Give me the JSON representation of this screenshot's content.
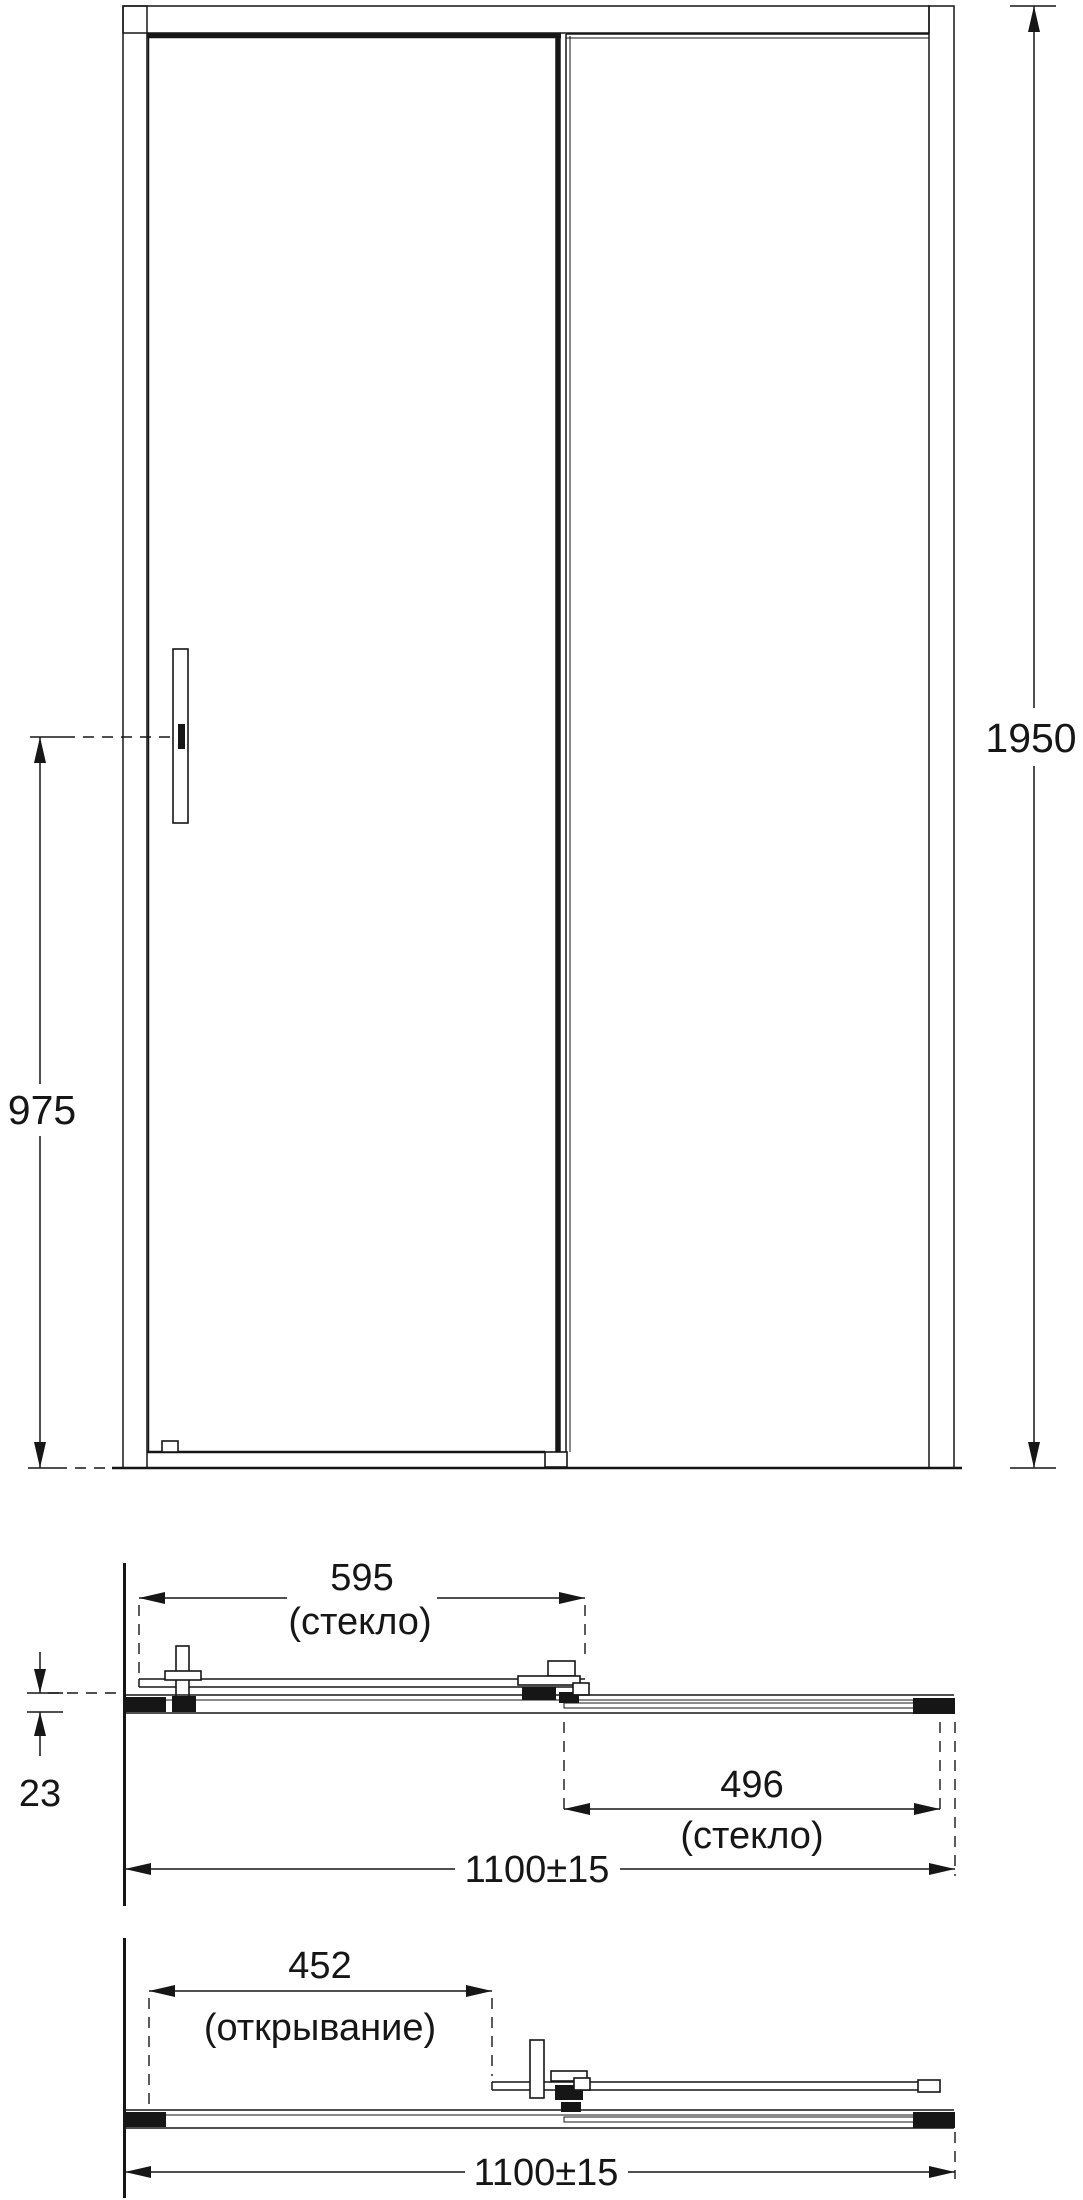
{
  "page": {
    "background": "#ffffff",
    "line_color": "#161616",
    "drawing_type": "shower sliding door installation diagram"
  },
  "front_view": {
    "dims": {
      "total_height": {
        "value": "1950"
      },
      "handle_height": {
        "value": "975"
      }
    }
  },
  "plan_closed": {
    "dims": {
      "door_glass": {
        "value": "595",
        "note": "(стекло)"
      },
      "fixed_glass": {
        "value": "496",
        "note": "(стекло)"
      },
      "profile_depth": {
        "value": "23"
      },
      "overall_width": {
        "value": "1100±15"
      }
    }
  },
  "plan_open": {
    "dims": {
      "opening": {
        "value": "452",
        "note": "(открывание)"
      },
      "overall_width": {
        "value": "1100±15"
      }
    }
  }
}
